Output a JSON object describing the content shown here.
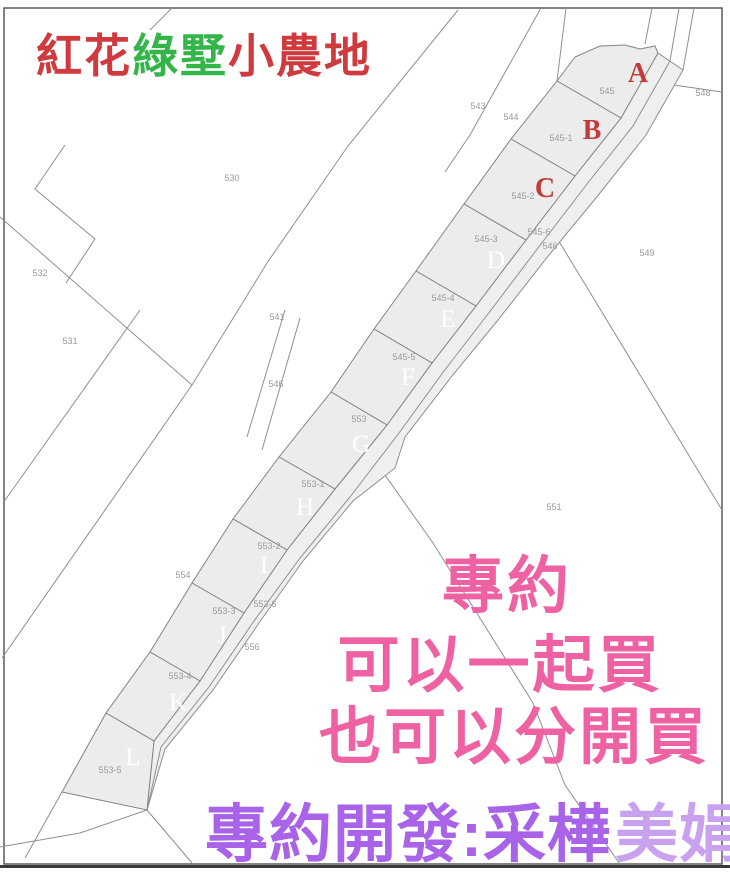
{
  "title": {
    "segments": [
      {
        "text": "紅花",
        "color": "#cf3a3f"
      },
      {
        "text": "綠墅",
        "color": "#33b54a"
      },
      {
        "text": "小農地",
        "color": "#cf3a3f"
      }
    ]
  },
  "map": {
    "parcels": [
      {
        "letter": "A",
        "lot": "545"
      },
      {
        "letter": "B",
        "lot": "545-1"
      },
      {
        "letter": "C",
        "lot": "545-2"
      },
      {
        "letter": "D",
        "lot": "545-3"
      },
      {
        "letter": "E",
        "lot": "545-4"
      },
      {
        "letter": "F",
        "lot": "545-5"
      },
      {
        "letter": "G",
        "lot": "553"
      },
      {
        "letter": "H",
        "lot": "553-1"
      },
      {
        "letter": "I",
        "lot": "553-2"
      },
      {
        "letter": "J",
        "lot": "553-3"
      },
      {
        "letter": "K",
        "lot": "553-4"
      },
      {
        "letter": "L",
        "lot": "553-5"
      }
    ],
    "neighbor_lots": [
      "530",
      "532",
      "531",
      "541",
      "543",
      "544",
      "545-6",
      "546",
      "546",
      "548",
      "549",
      "551",
      "554",
      "553-6",
      "556"
    ]
  },
  "promo": {
    "line1": "專約",
    "line2": "可以一起買",
    "line3": "也可以分開買"
  },
  "footer": {
    "agency": "專約開發:采樺",
    "agent": "美娟"
  },
  "colors": {
    "letter_red": "#c23b3b",
    "letter_light": "#ffffff",
    "promo_pink": "#ee61a2",
    "footer_purple": "#a863e8",
    "footer_light": "#c9a2ef",
    "parcel_fill": "#ececec",
    "line_gray": "#8f8f8f",
    "label_gray": "#9a9a9a",
    "title_red": "#cf3a3f",
    "title_green": "#33b54a"
  }
}
